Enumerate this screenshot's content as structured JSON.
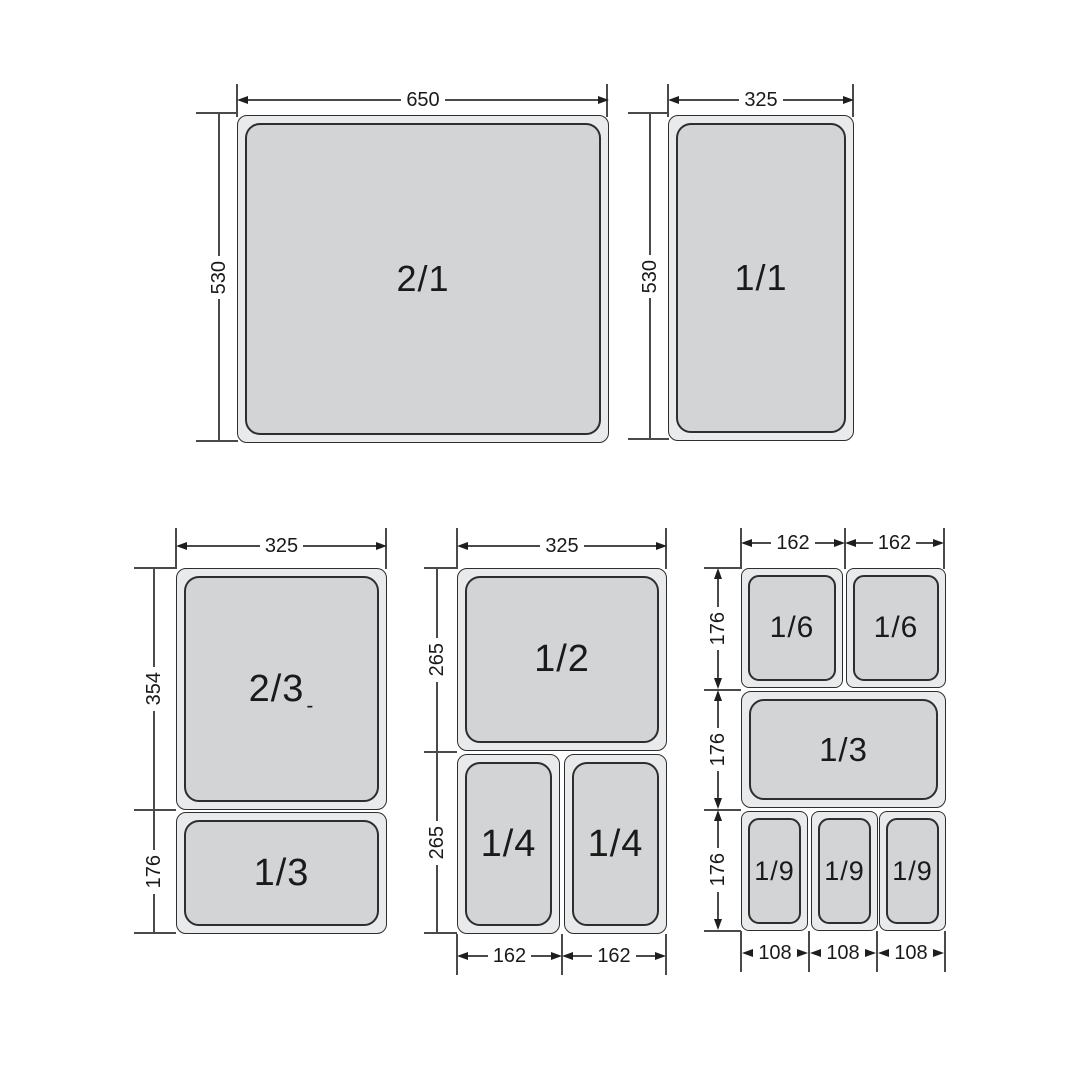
{
  "colors": {
    "pan_fill": "#d3d4d6",
    "pan_rim": "#e9eaeb",
    "outline": "#2e2e2e",
    "line": "#4a4a4a",
    "arrow": "#1e1e1e",
    "ink": "#1a1a1a",
    "bg": "#ffffff"
  },
  "pans": {
    "two_one": {
      "label": "2/1"
    },
    "one_one": {
      "label": "1/1"
    },
    "two_thirds": {
      "label": "2/3",
      "suffix": "-"
    },
    "one_third_left": {
      "label": "1/3"
    },
    "one_half": {
      "label": "1/2"
    },
    "one_quarter_a": {
      "label": "1/4"
    },
    "one_quarter_b": {
      "label": "1/4"
    },
    "one_sixth_a": {
      "label": "1/6"
    },
    "one_sixth_b": {
      "label": "1/6"
    },
    "one_third_right": {
      "label": "1/3"
    },
    "one_ninth_a": {
      "label": "1/9"
    },
    "one_ninth_b": {
      "label": "1/9"
    },
    "one_ninth_c": {
      "label": "1/9"
    }
  },
  "dims": {
    "w650": "650",
    "w325_full": "325",
    "h530_left": "530",
    "h530_right": "530",
    "w325_two_thirds": "325",
    "h354": "354",
    "h176_third_left": "176",
    "w325_half": "325",
    "h265_top": "265",
    "h265_bottom": "265",
    "w162_quarter_a": "162",
    "w162_quarter_b": "162",
    "w162_sixth_a": "162",
    "w162_sixth_b": "162",
    "h176_sixth": "176",
    "h176_third_right": "176",
    "h176_ninth": "176",
    "w108_a": "108",
    "w108_b": "108",
    "w108_c": "108"
  }
}
